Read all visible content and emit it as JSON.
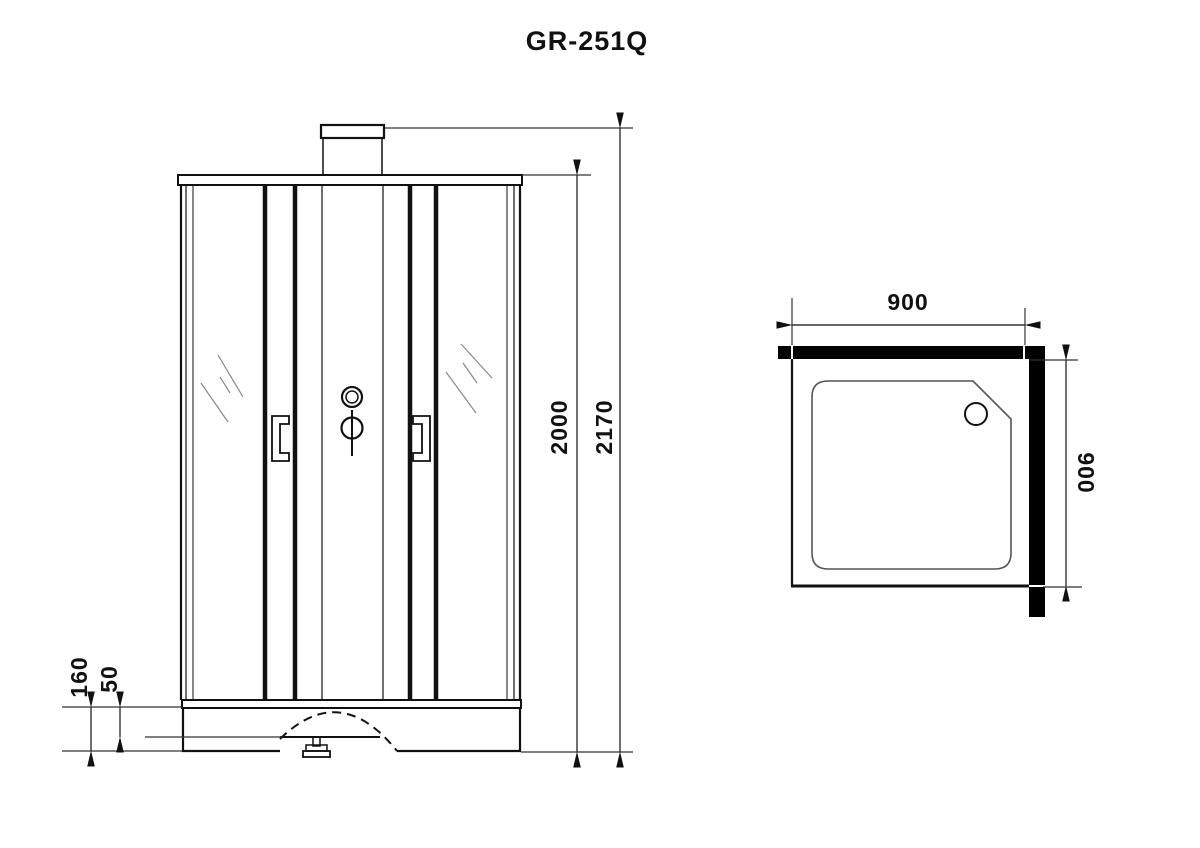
{
  "title": "GR-251Q",
  "front_view": {
    "dimensions": {
      "overall_height": "2170",
      "cabin_height": "2000",
      "tray_height": "160",
      "tray_step": "50"
    }
  },
  "plan_view": {
    "dimensions": {
      "width": "900",
      "depth": "900"
    }
  },
  "colors": {
    "line": "#111111",
    "dim_line": "#333333",
    "wall_fill": "#000000",
    "background": "#ffffff"
  }
}
